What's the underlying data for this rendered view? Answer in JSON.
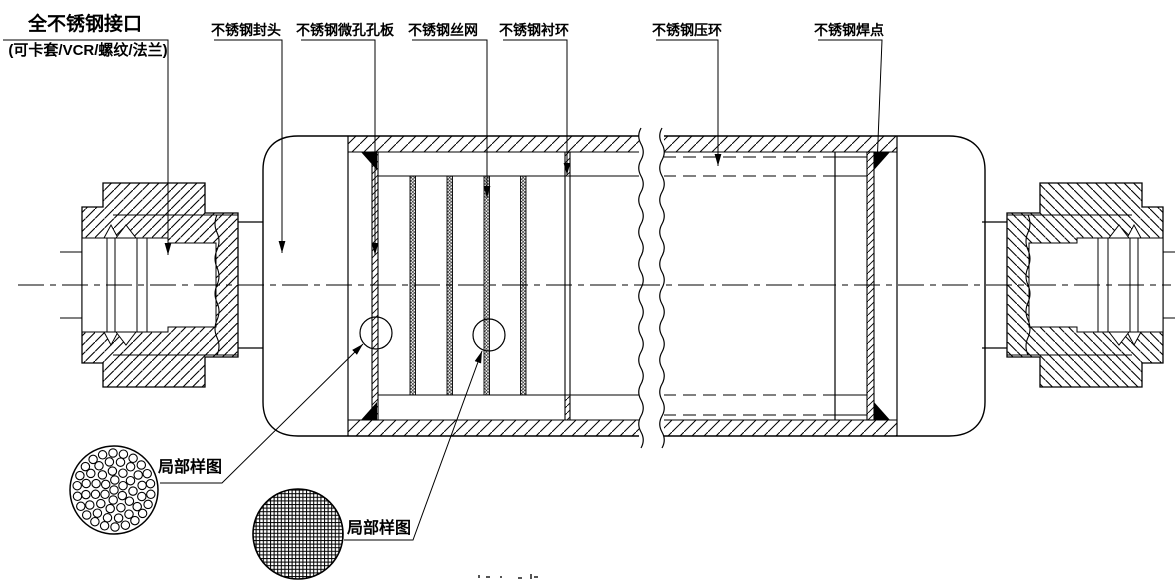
{
  "diagram": {
    "background": "#ffffff",
    "line_color": "#000000",
    "callouts": {
      "port_line1": "全不锈钢接口",
      "port_line2": "(可卡套/VCR/螺纹/法兰)",
      "head": "不锈钢封头",
      "micro_perforated_plate": "不锈钢微孔孔板",
      "wire_mesh": "不锈钢丝网",
      "liner_ring": "不锈钢衬环",
      "press_ring": "不锈钢压环",
      "weld_spot": "不锈钢焊点",
      "detail_sample_left": "局部样图",
      "detail_sample_right": "局部样图"
    }
  }
}
